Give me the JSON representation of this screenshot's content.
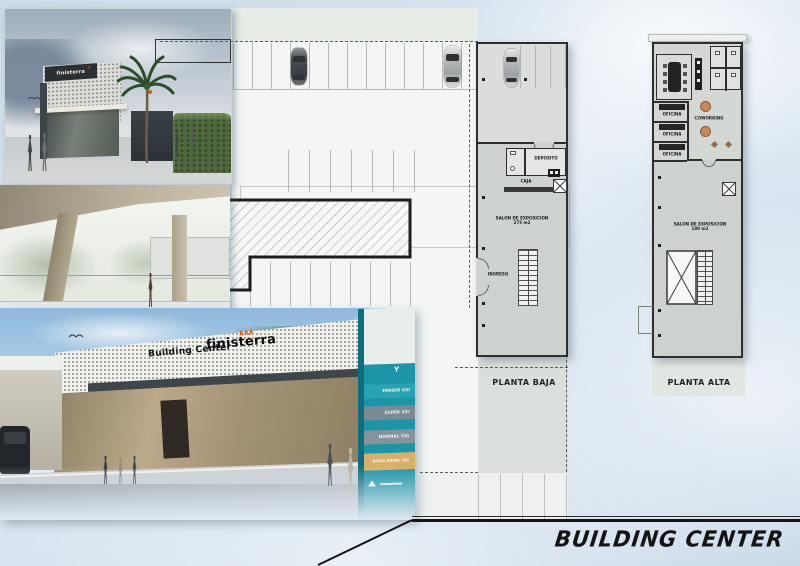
{
  "sheet": {
    "title": "BUILDING CENTER"
  },
  "plans": {
    "planta_baja": {
      "label": "PLANTA BAJA",
      "rooms": {
        "deposito": "DEPOSITO",
        "caja": "CAJA",
        "salon": "SALON DE EXPOSICION",
        "salon_area": "273 m2",
        "ingreso": "INGRESO"
      }
    },
    "planta_alta": {
      "label": "PLANTA ALTA",
      "rooms": {
        "oficina": "OFICINA",
        "coworking": "COWORKING",
        "salon": "SALON DE EXPOSICION",
        "salon_area": "180 m2"
      }
    }
  },
  "renders": {
    "entrance": {
      "brand": "finisterra"
    },
    "street": {
      "building_sign": "Building Center",
      "brand_sign": "finisterra",
      "logo_marks": "∧∧∧"
    },
    "pylon": {
      "labels": [
        "FANGIO XXI",
        "SUPER XXI",
        "NORMAL XXI",
        "ULTRA DIESEL XXI"
      ],
      "logo_letter": "Y"
    }
  },
  "colors": {
    "accent_orange": "#e8590c",
    "pylon_teal": "#1d95a8",
    "fuel_tan": "#d9b068",
    "plan_gray": "#d6dad6",
    "wall": "#2e2e2e"
  }
}
